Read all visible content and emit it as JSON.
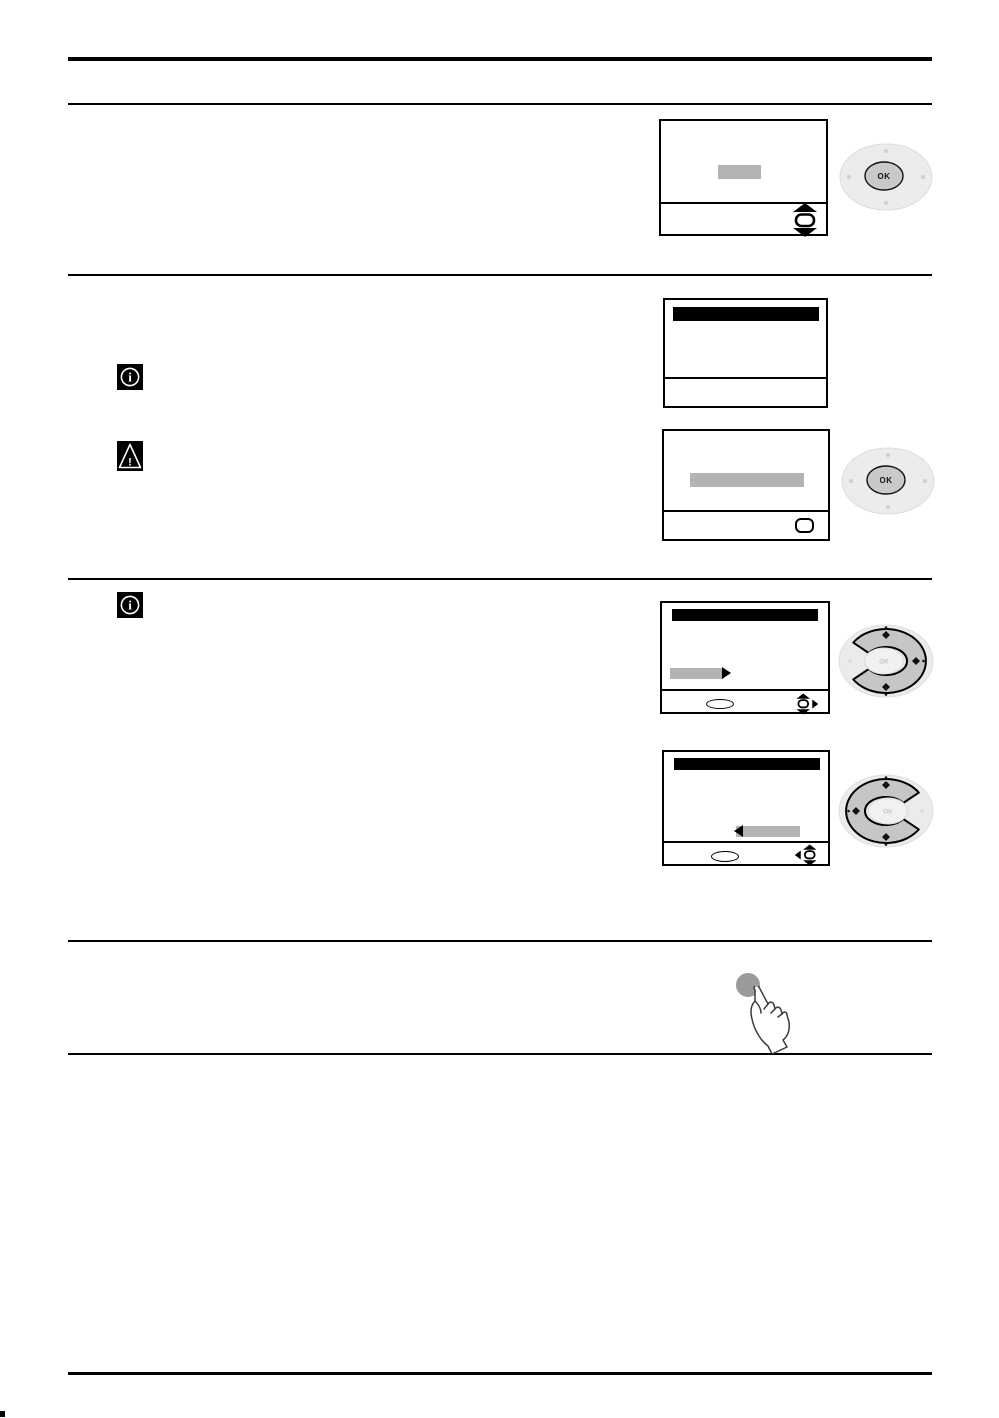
{
  "remote": {
    "ok_button_label": "OK",
    "dpad_center_label": "OK"
  },
  "icons": {
    "info_glyph": "i",
    "warning_glyph": "!",
    "info": "circled-i-on-black",
    "warning": "exclamation-triangle-on-black",
    "nav_up_down": "scroll-up-down",
    "nav_up_down_right": "scroll-up-down-plus-right-arrow",
    "nav_left_up_down": "left-arrow-plus-scroll-up-down",
    "dpad_a": "ring-highlight-up-right-down",
    "dpad_b": "ring-highlight-up-left-down",
    "press": "finger-pressing-button"
  },
  "colors": {
    "ink": "#000000",
    "highlight_gray": "#b3b3b3",
    "pad_outer": "#ececec",
    "pad_ring": "#dcdcdc",
    "pad_inner": "#c9c9c9",
    "dpad_outer": "#ebebeb",
    "dpad_ring": "#c6c6c6",
    "dpad_center": "#f1f1f1",
    "press_button": "#9a9a9a",
    "hand_outline": "#3c3c3c"
  }
}
